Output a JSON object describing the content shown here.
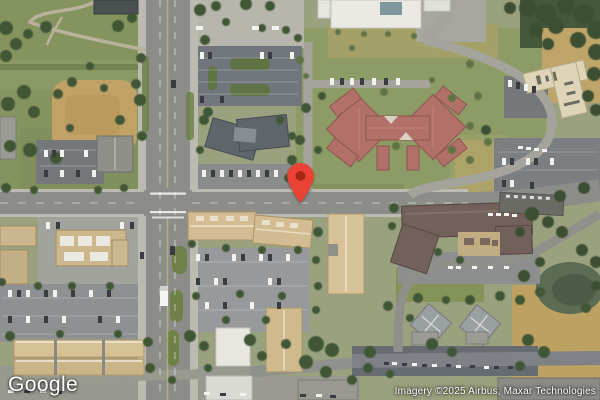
{
  "map": {
    "provider_logo": "Google",
    "attribution": "Imagery ©2025 Airbus, Maxar Technologies",
    "view_type": "satellite"
  },
  "marker": {
    "color": "#EA4335",
    "dot_color": "#A52714"
  }
}
